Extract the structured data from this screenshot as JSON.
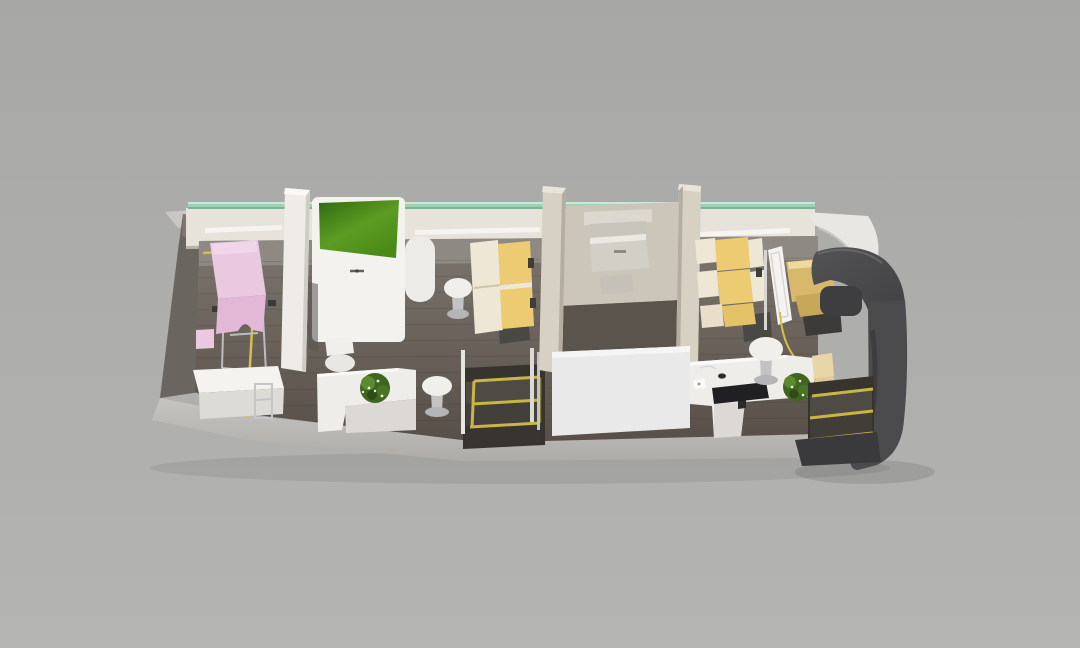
{
  "scene": {
    "subject": "mobile-clinic-bus-interior-cutaway-render",
    "view": "isometric-top-down",
    "objects": [
      {
        "id": "exam-chair",
        "label": "pink examination chair"
      },
      {
        "id": "side-bench",
        "label": "white bench"
      },
      {
        "id": "partition-wall",
        "label": "white partition wall"
      },
      {
        "id": "green-top-cabinet",
        "label": "white cabinet with green top"
      },
      {
        "id": "round-stool",
        "label": "white round stool"
      },
      {
        "id": "double-passenger-seat",
        "label": "two-seat yellow bench"
      },
      {
        "id": "lounge-desk",
        "label": "L-shaped white desk with plant"
      },
      {
        "id": "potted-plant",
        "label": "green potted plant"
      },
      {
        "id": "entry-steps-middle",
        "label": "middle entry steps with yellow trim"
      },
      {
        "id": "handrail",
        "label": "entry handrails"
      },
      {
        "id": "xray-room",
        "label": "enclosed x-ray room"
      },
      {
        "id": "xray-unit",
        "label": "wall-mounted x-ray unit"
      },
      {
        "id": "tandem-passenger-seats",
        "label": "two single yellow seats"
      },
      {
        "id": "privacy-screen",
        "label": "white privacy screen"
      },
      {
        "id": "driver-seat",
        "label": "tan driver seat"
      },
      {
        "id": "reception-desk",
        "label": "white reception desk with monitor"
      },
      {
        "id": "monitor",
        "label": "black desktop monitor"
      },
      {
        "id": "cream-bench-seat",
        "label": "small cream bench seat"
      },
      {
        "id": "entry-steps-front",
        "label": "front entry steps with yellow trim"
      },
      {
        "id": "cab-front",
        "label": "dark gray driver cab shell"
      },
      {
        "id": "windshield-frame",
        "label": "white windshield frame"
      },
      {
        "id": "window-glass-strip",
        "label": "teal glass window strip"
      }
    ]
  },
  "colors": {
    "background_top": "#a7a7a5",
    "background_bottom": "#b4b4b2",
    "hull_band": "#bdbbb7",
    "rear_wall_dark": "#6b655f",
    "top_wedge": "#c9c7c3",
    "wall_band": "#e7e3db",
    "sill_white": "#f6f4f0",
    "glass_green": "#9ed1b4",
    "floor_top": "#7d766e",
    "floor_bottom": "#574f48",
    "floor_light_strip": "#928d86",
    "yellow_line": "#d2c04a",
    "step_yellow": "#c9b544",
    "step_dark": "#37342f",
    "partition_white": "#efece7",
    "wall_beige": "#d7d1c4",
    "room_back": "#ccc6ba",
    "room_floor": "#5a544c",
    "room_front_wall": "#e9e9ea",
    "device_gray": "#d2cfc7",
    "device_plate": "#dcd8cf",
    "cabinet_white": "#f3f2ef",
    "green_top": "#55961d",
    "pink_chair": "#eac8e0",
    "pink_chair_dark": "#e2b8d6",
    "bench_white": "#f4f3f0",
    "bench_front": "#dddbd6",
    "chrome": "#c3c3c5",
    "stool_white": "#f1efec",
    "stool_base": "#b5b5b7",
    "seat_yellow": "#eccb72",
    "seat_cream": "#efe7d5",
    "seat_base_dark": "#4a4845",
    "desk_white": "#eeedea",
    "desk_front": "#dcd9d4",
    "plant_green": "#3f661f",
    "plant_green_light": "#5d8a31",
    "monitor_black": "#202022",
    "driver_seat_tan": "#d8b96c",
    "driver_seat_dark": "#c7a75a",
    "cab_dark": "#4b4b4d",
    "cab_darker": "#3a393b",
    "windshield_frame": "#e9e7e3",
    "screen_white": "#f4f3f1",
    "cream_bench": "#e8d6a8",
    "tread_gray": "#4e4a44"
  }
}
